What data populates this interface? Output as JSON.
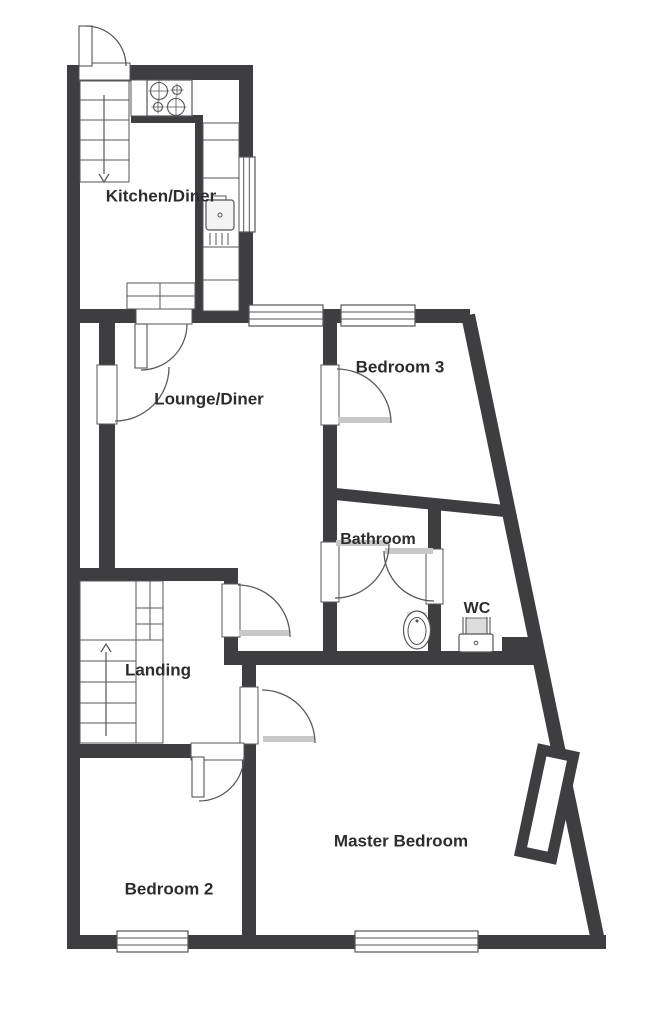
{
  "plan_title": "First floor plan",
  "colors": {
    "background": "#ffffff",
    "wall": "#3e3e41",
    "thin_line": "#55555a",
    "arc_line": "#5a5a5c",
    "text": "#2c2c2e",
    "door_leaf_gray": "#c8c8c8",
    "fixture_shade": "#dcdcdc"
  },
  "rooms": [
    {
      "id": "kitchen-diner",
      "label": "Kitchen/Diner",
      "x": 161,
      "y": 197,
      "size": 17
    },
    {
      "id": "lounge-diner",
      "label": "Lounge/Diner",
      "x": 209,
      "y": 400,
      "size": 17
    },
    {
      "id": "bedroom-3",
      "label": "Bedroom 3",
      "x": 400,
      "y": 368,
      "size": 17
    },
    {
      "id": "bathroom",
      "label": "Bathroom",
      "x": 378,
      "y": 540,
      "size": 16
    },
    {
      "id": "wc",
      "label": "WC",
      "x": 477,
      "y": 609,
      "size": 16
    },
    {
      "id": "landing",
      "label": "Landing",
      "x": 158,
      "y": 671,
      "size": 17
    },
    {
      "id": "bedroom-2",
      "label": "Bedroom 2",
      "x": 169,
      "y": 890,
      "size": 17
    },
    {
      "id": "master-bedroom",
      "label": "Master Bedroom",
      "x": 401,
      "y": 842,
      "size": 17
    }
  ],
  "geometry": {
    "walls": [
      {
        "name": "exterior-left-wall",
        "r": [
          67,
          65,
          13,
          884
        ]
      },
      {
        "name": "kitchen-top-wall",
        "r": [
          67,
          65,
          186,
          15
        ]
      },
      {
        "name": "kitchen-right-wall",
        "r": [
          239,
          65,
          14,
          246
        ]
      },
      {
        "name": "main-top-wall",
        "r": [
          80,
          309,
          390,
          14
        ]
      },
      {
        "name": "under-hob-wall",
        "r": [
          131,
          115,
          72,
          8
        ]
      },
      {
        "name": "kitchen-mid-wall",
        "r": [
          195,
          117,
          8,
          194
        ]
      },
      {
        "name": "cupboard-wall",
        "r": [
          99,
          323,
          16,
          245
        ]
      },
      {
        "name": "landing-top-wall",
        "r": [
          67,
          568,
          170,
          13
        ]
      },
      {
        "name": "landing-right-wall",
        "r": [
          224,
          568,
          14,
          97
        ]
      },
      {
        "name": "mid-horizontal-wall",
        "r": [
          237,
          651,
          308,
          14
        ]
      },
      {
        "name": "wc-step-wall",
        "r": [
          502,
          637,
          40,
          16
        ]
      },
      {
        "name": "landing-bottom-wall",
        "r": [
          67,
          744,
          189,
          14
        ]
      },
      {
        "name": "bedroom2-right-wall",
        "r": [
          242,
          665,
          14,
          284
        ]
      },
      {
        "name": "exterior-bottom-wall",
        "r": [
          67,
          935,
          539,
          14
        ]
      },
      {
        "name": "bed3-bath-left-wall",
        "r": [
          323,
          309,
          14,
          356
        ]
      },
      {
        "name": "bathroom-right-wall",
        "r": [
          428,
          503,
          13,
          162
        ]
      }
    ],
    "diagonal_walls": [
      {
        "name": "bed3-bath-slant-wall",
        "p": [
          325,
          493,
          505,
          511
        ],
        "w": 12
      },
      {
        "name": "exterior-diagonal-wall",
        "p": [
          468,
          315,
          598,
          941
        ],
        "w": 14
      }
    ],
    "chimney": {
      "cx": 547,
      "cy": 804,
      "rot": 12,
      "w": 32,
      "h": 104,
      "stroke": 11
    },
    "openings": [
      {
        "name": "entrance-door-opening",
        "r": [
          79,
          63,
          51,
          18
        ]
      },
      {
        "name": "kitchen-door-opening",
        "r": [
          136,
          307,
          56,
          17
        ]
      },
      {
        "name": "cupboard-door-opening",
        "r": [
          97,
          365,
          20,
          59
        ]
      },
      {
        "name": "bedroom3-door-opening",
        "r": [
          321,
          365,
          18,
          60
        ]
      },
      {
        "name": "bathroom-left-door-opening",
        "r": [
          321,
          542,
          18,
          60
        ]
      },
      {
        "name": "bathroom-right-door-opening",
        "r": [
          426,
          549,
          17,
          55
        ]
      },
      {
        "name": "landing-door-opening",
        "r": [
          222,
          584,
          18,
          53
        ]
      },
      {
        "name": "master-door-opening",
        "r": [
          240,
          687,
          18,
          57
        ]
      },
      {
        "name": "bedroom2-door-opening",
        "r": [
          191,
          743,
          53,
          17
        ]
      }
    ],
    "windows": [
      {
        "name": "kitchen-window",
        "r": [
          238,
          157,
          17,
          75
        ],
        "orient": "v"
      },
      {
        "name": "lounge-window",
        "r": [
          249,
          305,
          74,
          21
        ],
        "orient": "h"
      },
      {
        "name": "bedroom3-window",
        "r": [
          341,
          305,
          74,
          21
        ],
        "orient": "h"
      },
      {
        "name": "bedroom2-window",
        "r": [
          117,
          931,
          71,
          21
        ],
        "orient": "h"
      },
      {
        "name": "master-bedroom-window",
        "r": [
          355,
          931,
          123,
          21
        ],
        "orient": "h"
      }
    ],
    "door_arcs": [
      {
        "name": "entrance-door-arc",
        "d": "M 86,26 A 40,40 0 0 1 126,66"
      },
      {
        "name": "kitchen-door-arc",
        "d": "M 141,370 A 46,46 0 0 0 187,324"
      },
      {
        "name": "cupboard-door-arc",
        "d": "M 115,421 A 54,54 0 0 0 169,367"
      },
      {
        "name": "bedroom3-door-arc",
        "d": "M 337,369 A 54,54 0 0 1 391,423"
      },
      {
        "name": "bathroom-left-door-arc",
        "d": "M 389,544 A 54,54 0 0 1 335,598"
      },
      {
        "name": "bathroom-right-door-arc",
        "d": "M 384,551 A 50,50 0 0 0 434,601"
      },
      {
        "name": "landing-door-arc",
        "d": "M 238,585 A 52,52 0 0 1 290,637"
      },
      {
        "name": "master-door-arc",
        "d": "M 262,690 A 53,53 0 0 1 315,743"
      },
      {
        "name": "bedroom2-door-arc",
        "d": "M 199,801 A 45,45 0 0 0 244,757"
      }
    ],
    "door_leaves_white": [
      {
        "name": "entrance-door-leaf",
        "r": [
          79,
          26,
          13,
          40
        ]
      },
      {
        "name": "kitchen-door-leaf",
        "r": [
          135,
          324,
          12,
          44
        ]
      },
      {
        "name": "bedroom2-door-leaf",
        "r": [
          192,
          757,
          12,
          40
        ]
      }
    ],
    "door_leaves_gray": [
      {
        "name": "bedroom3-door-leaf",
        "r": [
          338,
          417,
          52,
          6
        ]
      },
      {
        "name": "bathroom-left-door-leaf",
        "r": [
          336,
          540,
          52,
          6
        ]
      },
      {
        "name": "bathroom-right-door-leaf",
        "r": [
          385,
          548,
          48,
          6
        ]
      },
      {
        "name": "landing-door-leaf",
        "r": [
          239,
          630,
          50,
          6
        ]
      },
      {
        "name": "master-door-leaf",
        "r": [
          263,
          736,
          51,
          6
        ]
      }
    ],
    "stairs": [
      {
        "name": "kitchen-stairs",
        "box": [
          80,
          80,
          49,
          102
        ],
        "hlines": [
          [
            80,
            129,
            100
          ],
          [
            80,
            129,
            120
          ],
          [
            80,
            129,
            140
          ],
          [
            80,
            129,
            160
          ]
        ],
        "vlines": [],
        "arrow": {
          "x": 104,
          "y1": 95,
          "y2": 174,
          "dir": "down"
        }
      },
      {
        "name": "landing-stairs",
        "box": [
          80,
          581,
          83,
          162
        ],
        "hlines": [
          [
            80,
            163,
            640
          ],
          [
            136,
            163,
            608
          ],
          [
            136,
            163,
            624
          ],
          [
            80,
            136,
            661
          ],
          [
            80,
            136,
            682
          ],
          [
            80,
            136,
            703
          ],
          [
            80,
            136,
            723
          ]
        ],
        "vlines": [
          [
            136,
            581,
            743
          ],
          [
            150,
            581,
            640
          ]
        ],
        "arrow": {
          "x": 106,
          "y1": 736,
          "y2": 652,
          "dir": "up"
        }
      }
    ],
    "fixtures": {
      "hob": {
        "counter_end": [
          131,
          80,
          16,
          36
        ],
        "body": [
          147,
          80,
          45,
          36
        ],
        "burners": [
          [
            159,
            91,
            8.5
          ],
          [
            177,
            90,
            4.5
          ],
          [
            158,
            107,
            4.5
          ],
          [
            176,
            107,
            8.5
          ]
        ]
      },
      "counter": {
        "body": [
          203,
          123,
          36,
          188
        ],
        "dividers_y": [
          140,
          178,
          247,
          280
        ],
        "sink": [
          206,
          200,
          28,
          30
        ],
        "sink_dot": [
          220,
          215
        ],
        "drainer_x": [
          210,
          216,
          222,
          228
        ],
        "drainer_y": [
          233,
          245
        ]
      },
      "label_leader": [
        [
          214,
          196
        ],
        [
          226,
          196
        ],
        [
          226,
          200
        ]
      ],
      "table": {
        "rect": [
          127,
          283,
          68,
          26
        ],
        "vline_x": 160,
        "hline_y": 296
      },
      "toilet": {
        "shade": [
          407,
          612,
          20,
          7
        ],
        "outer": [
          417,
          630,
          13.5,
          19
        ],
        "inner": [
          417,
          631,
          9,
          13.5
        ],
        "dot": [
          417,
          621
        ]
      },
      "wc_basin": {
        "shade": [
          466,
          618,
          21,
          16
        ],
        "lines": [
          [
            463,
            617,
            463,
            634
          ],
          [
            466,
            617,
            466,
            634
          ],
          [
            487,
            617,
            487,
            634
          ],
          [
            490,
            617,
            490,
            634
          ]
        ],
        "body": [
          459,
          634,
          34,
          18
        ],
        "dot": [
          476,
          643
        ]
      }
    }
  }
}
